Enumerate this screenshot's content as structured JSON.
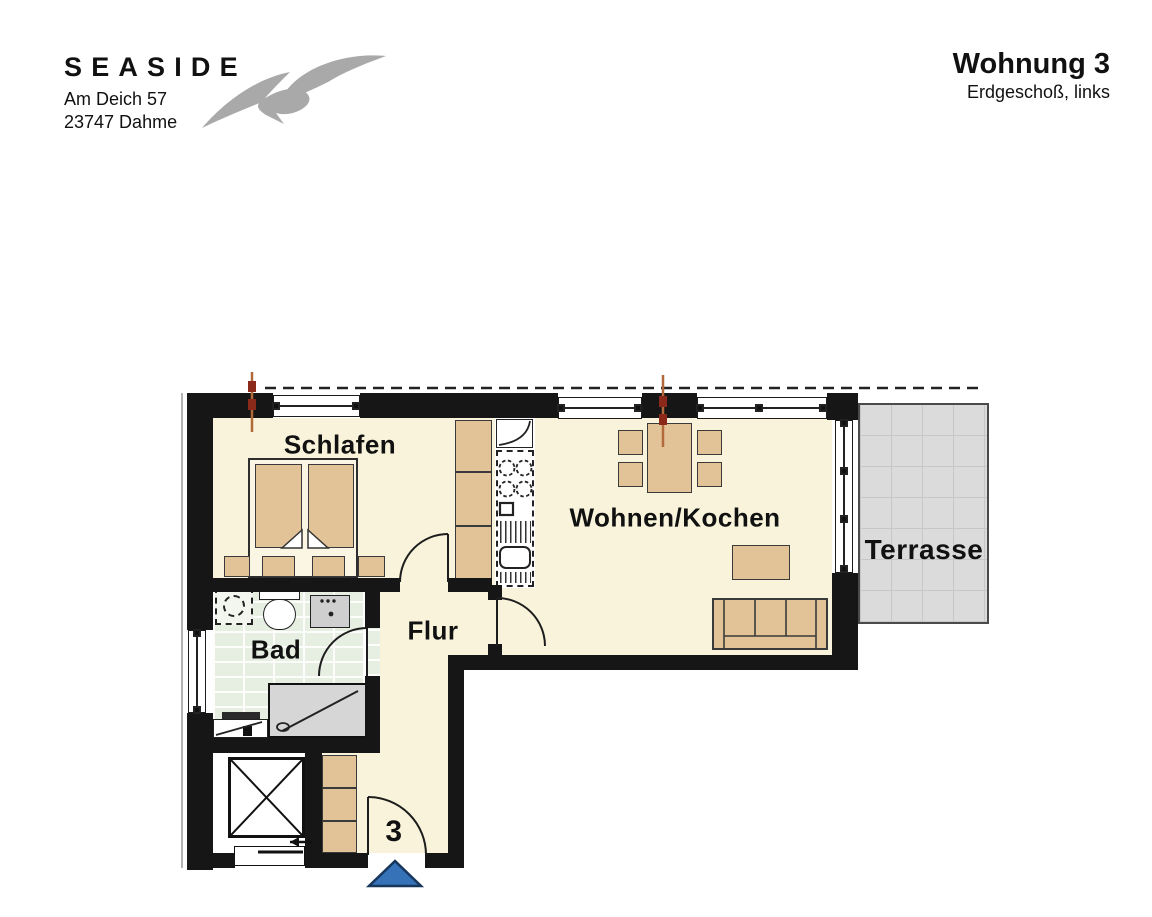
{
  "header": {
    "brand": "SEASIDE",
    "address_line1": "Am Deich 57",
    "address_line2": "23747 Dahme",
    "title": "Wohnung 3",
    "subtitle": "Erdgeschoß, links"
  },
  "plan": {
    "rooms": {
      "bedroom": "Schlafen",
      "living": "Wohnen/Kochen",
      "hall": "Flur",
      "bath": "Bad",
      "terrace": "Terrasse"
    },
    "entrance_number": "3"
  },
  "icons": {
    "logo": "seagull-icon",
    "elevator": "elevator-cross-icon",
    "entrance": "entrance-arrow-icon",
    "stairs": "stair-direction-arrow-icon"
  },
  "colors": {
    "wall": "#161616",
    "floor": "#f8f3da",
    "furniture": "#e2c397",
    "bath_tile": "#e7efe3",
    "terrace": "#dbdbdb",
    "section_marker": "#b26a3a",
    "entrance_arrow": "#3572b8"
  }
}
